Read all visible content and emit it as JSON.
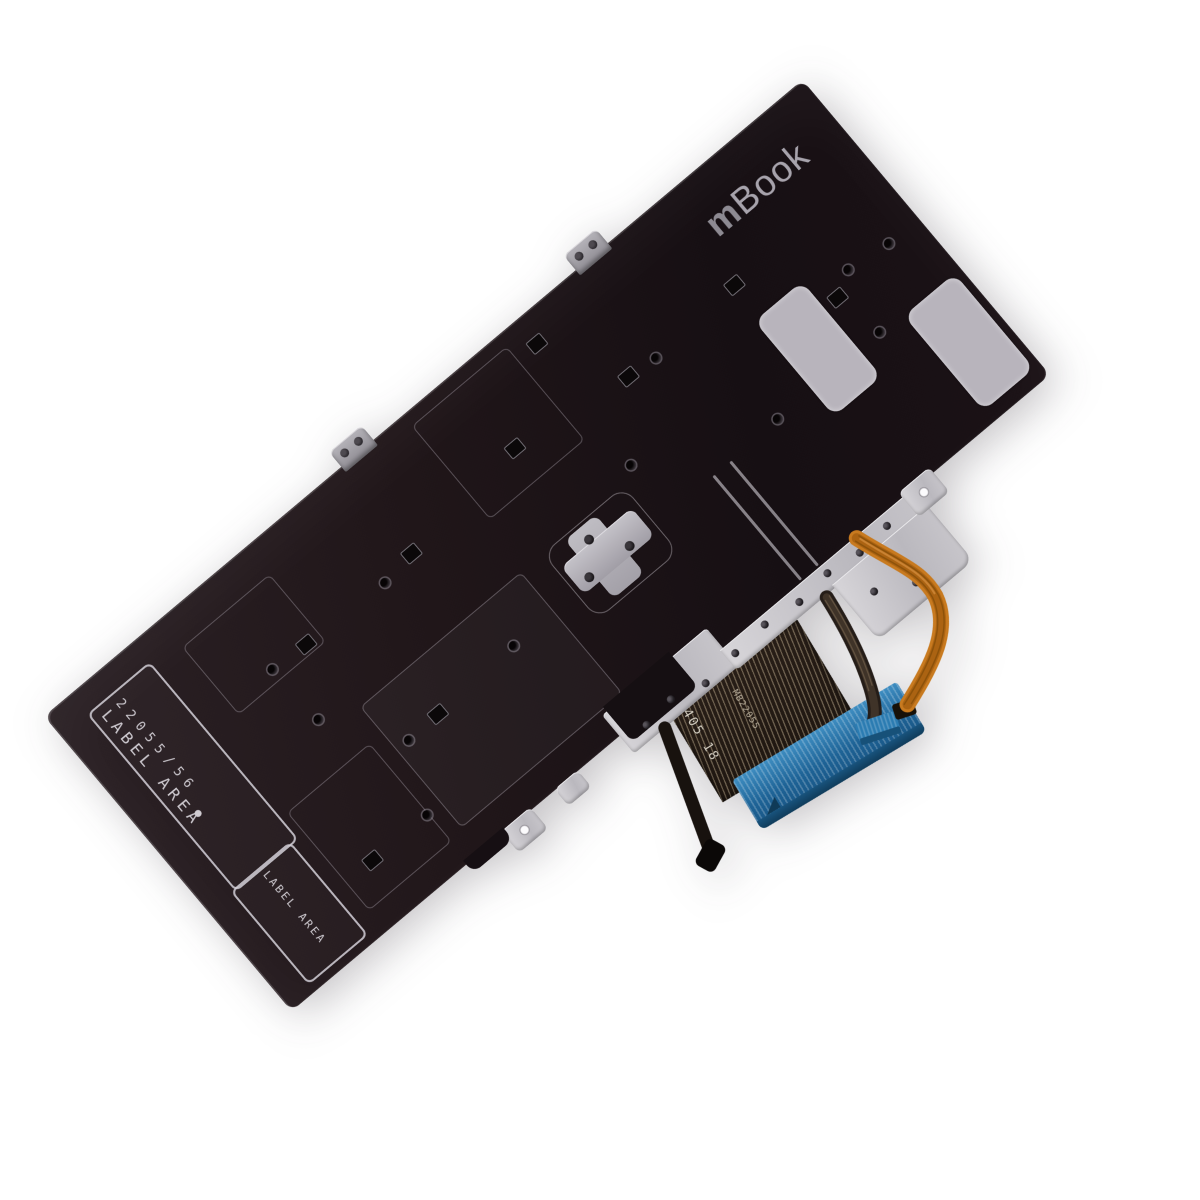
{
  "photo": {
    "subject": "laptop keyboard backplate replacement part",
    "background_color": "#ffffff"
  },
  "branding": {
    "logo_prefix": "m",
    "logo_suffix": "Book"
  },
  "labels": {
    "part_number": "22055/56",
    "label_area_primary": "LABEL AREA",
    "label_area_secondary": "LABEL AREA",
    "marker_dot": "•"
  },
  "cable_markings": {
    "date_code": "2405 18",
    "model_code": "MB22055"
  },
  "colors": {
    "plate_black": "#1c1317",
    "etch_line": "#cdc9cf",
    "sticker_gray": "#b8b4bc",
    "bracket_silver": "#c2c0c6",
    "orange_cable": "#c87a1f",
    "connector_blue": "#2176ad",
    "fpc_dark": "#241b15"
  }
}
